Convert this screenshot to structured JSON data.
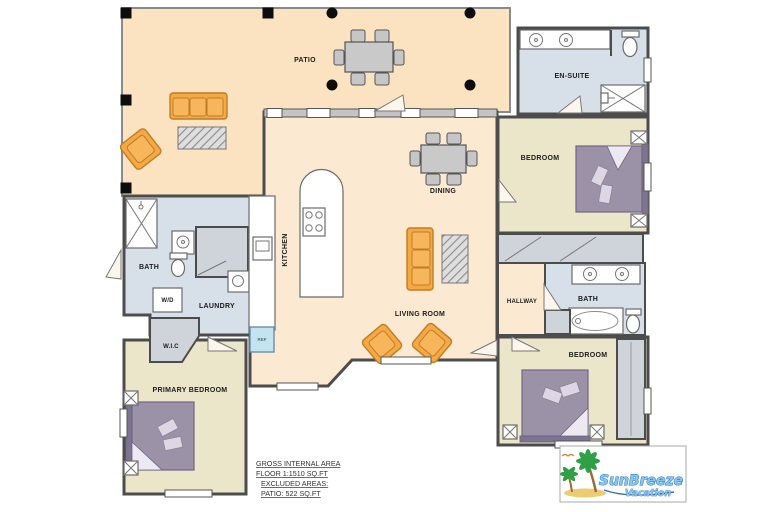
{
  "plan": {
    "rooms": {
      "patio": "PATIO",
      "dining": "DINING",
      "kitchen": "KITCHEN",
      "living_room": "LIVING ROOM",
      "en_suite": "EN-SUITE",
      "bedroom_top": "BEDROOM",
      "hallway": "HALLWAY",
      "bath_right": "BATH",
      "bedroom_right": "BEDROOM",
      "bath_left": "BATH",
      "laundry": "LAUNDRY",
      "washer_dryer": "W/D",
      "walk_in_closet": "W.I.C",
      "primary_bedroom": "PRIMARY BEDROOM",
      "fridge": "REF"
    },
    "area_summary": {
      "line1": "GROSS INTERNAL AREA",
      "line2": "FLOOR 1:1510 SQ.FT",
      "line3": "EXCLUDED AREAS:",
      "line4": "PATIO: 522 SQ.FT"
    },
    "logo": {
      "brand": "SunBreeze",
      "sub": "Vacation"
    },
    "colors": {
      "floor_peach": "#fce9d2",
      "patio_peach": "#fbe2c0",
      "bedroom_beige": "#ebe5ca",
      "bath_blue": "#d7dfe9",
      "furniture_orange": "#f5a843",
      "bed_purple": "#9c92a8",
      "closet_gray": "#ccccd0",
      "logo_blue": "#85c7f2",
      "wall_gray": "#4c4c4c"
    }
  }
}
